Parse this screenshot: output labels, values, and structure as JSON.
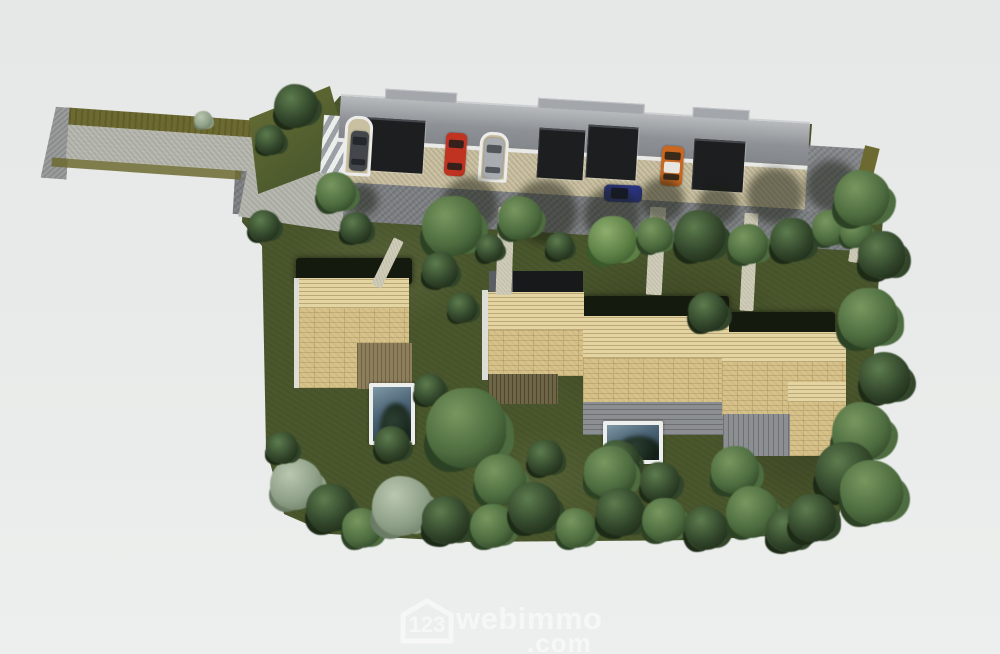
{
  "watermark": {
    "logo_number": "123",
    "brand": "webimmo",
    "tld": ".com",
    "color": "#ffffff",
    "opacity": 0.5
  },
  "palette": {
    "bg": "#e8eae9",
    "lawn": "#4a562c",
    "road": "#b7b8af",
    "cap": "#9b9c9c",
    "olive": "#6d6a31",
    "driveway": "#7c7f82",
    "beige": "#c9c0a1",
    "roofband_hi": "#b7babd",
    "roofband": "#8e9296",
    "fascia": "#e9eae7",
    "panel": "#1c1e20",
    "tile": "#d7c28a",
    "ridge": "#e3d4a2",
    "deck": "#8d7f5c",
    "terrace": "#8c8f92",
    "hedge": "#151a0f",
    "pool_frame": "#edefed",
    "pool_hi": "#7e97a4",
    "pool_lo": "#253845",
    "white_edge": "#e9e9e5"
  },
  "scene": {
    "houses": [
      {
        "id": "house-1",
        "position": "left",
        "roof": "beige-tile",
        "deck": true,
        "pool": true
      },
      {
        "id": "house-2",
        "position": "center",
        "roof": "beige-tile",
        "terrace": true,
        "pool": true,
        "dark_flat_roof": true
      },
      {
        "id": "house-3",
        "position": "right",
        "roof": "beige-tile",
        "terrace": true,
        "pool": false
      }
    ],
    "pools": [
      {
        "x": 369,
        "y": 383,
        "w": 46,
        "h": 62
      },
      {
        "x": 603,
        "y": 421,
        "w": 60,
        "h": 43
      }
    ],
    "cars": [
      {
        "name": "black-car",
        "x": 350,
        "y": 131,
        "w": 18,
        "h": 40,
        "rot": 4,
        "body": "#43474b",
        "glass": "#24272b",
        "shape": "v"
      },
      {
        "name": "red-car",
        "x": 445,
        "y": 133,
        "w": 21,
        "h": 43,
        "rot": 4,
        "body": "#c03320",
        "glass": "#35201c",
        "shape": "v"
      },
      {
        "name": "silver-car",
        "x": 484,
        "y": 138,
        "w": 19,
        "h": 41,
        "rot": 4,
        "body": "#a9adb1",
        "glass": "#51565a",
        "shape": "v"
      },
      {
        "name": "orange-car",
        "x": 661,
        "y": 146,
        "w": 22,
        "h": 40,
        "rot": 4,
        "body": "#c9661f",
        "glass": "#3a2a1a",
        "roof": "#e7e5e0",
        "shape": "v"
      },
      {
        "name": "blue-car",
        "x": 604,
        "y": 185,
        "w": 38,
        "h": 17,
        "rot": 2,
        "body": "#2a3480",
        "glass": "#141830",
        "shape": "h"
      }
    ],
    "garage_panels": [
      {
        "x": 366,
        "y": 119,
        "w": 58,
        "h": 53
      },
      {
        "x": 538,
        "y": 129,
        "w": 46,
        "h": 50
      },
      {
        "x": 587,
        "y": 126,
        "w": 50,
        "h": 53
      },
      {
        "x": 693,
        "y": 140,
        "w": 51,
        "h": 51
      }
    ],
    "carport_stalls": [
      {
        "x": 344,
        "y": 116,
        "w": 28,
        "h": 60
      },
      {
        "x": 479,
        "y": 132,
        "w": 29,
        "h": 50
      }
    ],
    "roof_bumps": [
      [
        44,
        72
      ],
      [
        197,
        107
      ],
      [
        352,
        57
      ]
    ],
    "footpaths": [
      {
        "x": 382,
        "y": 237,
        "w": 11,
        "h": 52,
        "rot": 26
      },
      {
        "x": 432,
        "y": 212,
        "w": 15,
        "h": 68,
        "rot": 2
      },
      {
        "x": 497,
        "y": 207,
        "w": 16,
        "h": 88,
        "rot": 2
      },
      {
        "x": 648,
        "y": 207,
        "w": 16,
        "h": 88,
        "rot": 3
      },
      {
        "x": 742,
        "y": 213,
        "w": 14,
        "h": 98,
        "rot": 3
      },
      {
        "x": 852,
        "y": 211,
        "w": 15,
        "h": 52,
        "rot": 9
      }
    ],
    "tree_kinds": {
      "d": {
        "base": "#31452a",
        "hi": "#5d7c4e",
        "lo": "#1c2a16"
      },
      "m": {
        "base": "#4d6c3f",
        "hi": "#78975f",
        "lo": "#2c4224"
      },
      "g": {
        "base": "#5d8046",
        "hi": "#8fae6f",
        "lo": "#3a5a2c"
      },
      "s": {
        "base": "#8fa088",
        "hi": "#bac7b1",
        "lo": "#6b7c66"
      }
    },
    "trees": [
      [
        "d",
        296,
        106,
        22
      ],
      [
        "d",
        270,
        140,
        15
      ],
      [
        "s",
        203,
        120,
        9
      ],
      [
        "m",
        336,
        192,
        20
      ],
      [
        "d",
        264,
        226,
        16
      ],
      [
        "d",
        356,
        228,
        16
      ],
      [
        "m",
        452,
        226,
        30
      ],
      [
        "d",
        490,
        248,
        14
      ],
      [
        "m",
        520,
        218,
        22
      ],
      [
        "d",
        560,
        246,
        14
      ],
      [
        "g",
        612,
        240,
        24
      ],
      [
        "m",
        655,
        235,
        18
      ],
      [
        "d",
        700,
        236,
        26
      ],
      [
        "m",
        748,
        244,
        20
      ],
      [
        "d",
        792,
        240,
        22
      ],
      [
        "m",
        830,
        228,
        18
      ],
      [
        "m",
        856,
        232,
        16
      ],
      [
        "d",
        440,
        270,
        18
      ],
      [
        "d",
        462,
        308,
        15
      ],
      [
        "d",
        708,
        312,
        20
      ],
      [
        "m",
        862,
        198,
        28
      ],
      [
        "d",
        882,
        255,
        24
      ],
      [
        "m",
        868,
        318,
        30
      ],
      [
        "d",
        885,
        378,
        26
      ],
      [
        "m",
        862,
        432,
        30
      ],
      [
        "d",
        430,
        390,
        16
      ],
      [
        "m",
        466,
        428,
        40
      ],
      [
        "d",
        392,
        444,
        18
      ],
      [
        "d",
        618,
        462,
        22
      ],
      [
        "m",
        610,
        472,
        26
      ],
      [
        "d",
        545,
        458,
        18
      ],
      [
        "m",
        500,
        480,
        26
      ],
      [
        "d",
        660,
        482,
        20
      ],
      [
        "m",
        735,
        470,
        24
      ],
      [
        "d",
        845,
        472,
        30
      ],
      [
        "m",
        872,
        492,
        32
      ],
      [
        "s",
        296,
        484,
        26
      ],
      [
        "d",
        282,
        448,
        16
      ],
      [
        "d",
        330,
        508,
        24
      ],
      [
        "m",
        362,
        528,
        20
      ],
      [
        "s",
        402,
        506,
        30
      ],
      [
        "d",
        446,
        520,
        24
      ],
      [
        "m",
        492,
        526,
        22
      ],
      [
        "d",
        534,
        508,
        26
      ],
      [
        "m",
        576,
        528,
        20
      ],
      [
        "d",
        620,
        512,
        24
      ],
      [
        "m",
        664,
        520,
        22
      ],
      [
        "d",
        706,
        528,
        22
      ],
      [
        "m",
        752,
        512,
        26
      ],
      [
        "d",
        788,
        530,
        22
      ],
      [
        "d",
        812,
        518,
        24
      ]
    ],
    "driveway_shadows": [
      [
        470,
        205,
        28
      ],
      [
        545,
        212,
        32
      ],
      [
        612,
        215,
        28
      ],
      [
        662,
        200,
        22
      ],
      [
        775,
        196,
        28
      ],
      [
        832,
        186,
        26
      ],
      [
        362,
        200,
        16
      ],
      [
        718,
        205,
        20
      ]
    ]
  }
}
